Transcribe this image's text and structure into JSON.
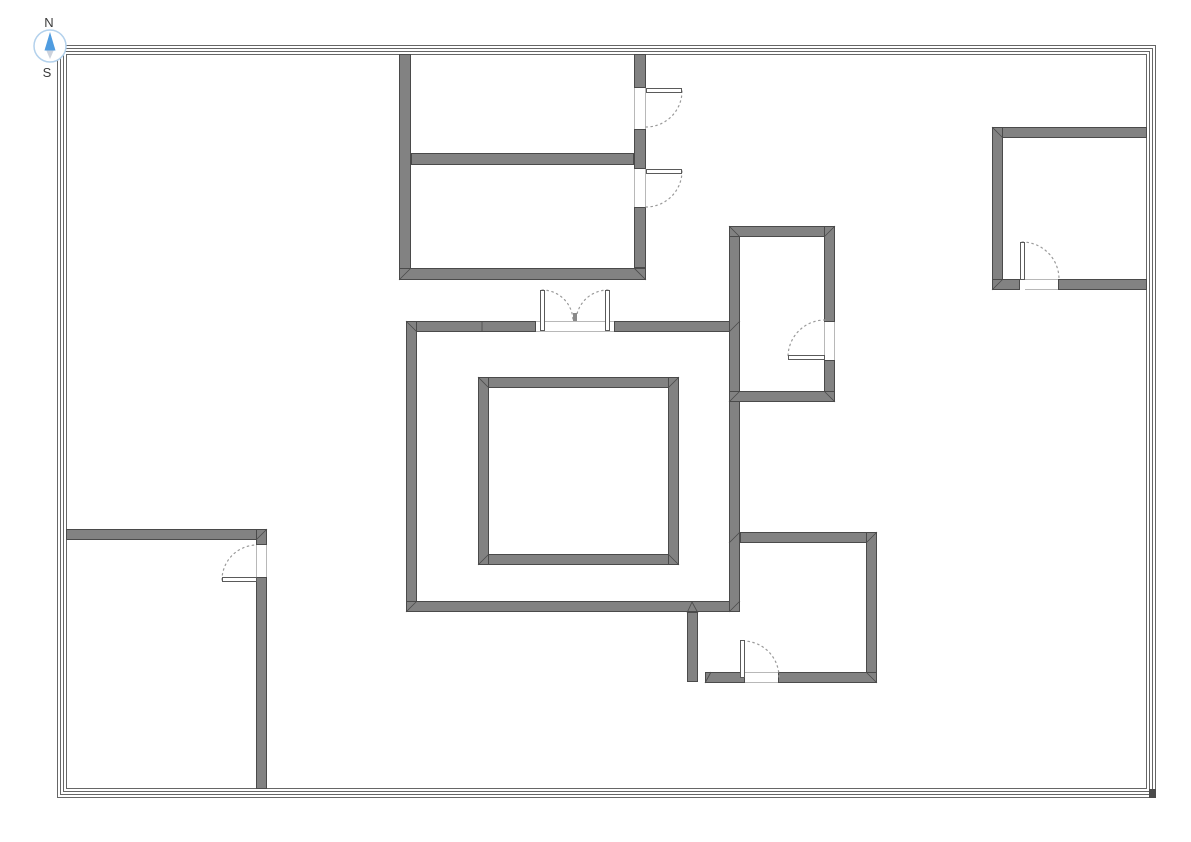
{
  "canvas": {
    "width": 1191,
    "height": 842,
    "background": "#ffffff"
  },
  "colors": {
    "wall_fill": "#828282",
    "wall_stroke": "#4a4a4a",
    "border_line": "#666666",
    "arc_stroke": "#9a9a9a",
    "leaf_fill": "#ffffff",
    "leaf_stroke": "#5a5a5a",
    "threshold_line": "#b8b8b8",
    "seam_stroke": "#4a4a4a",
    "tick_fill": "#8a8a8a",
    "corner_block_fill": "#4a4a4a"
  },
  "compass": {
    "cx": 50,
    "cy": 46,
    "r": 16,
    "ring_color": "#b3d1ec",
    "north_label": "N",
    "south_label": "S",
    "north_color": "#4f9ce0",
    "south_color": "#ccd2dc",
    "label_color": "#3a3a3a",
    "label_font_size": 13,
    "north_points": "50,32 44.5,50.5 55.5,50.5",
    "south_points": "45,47.5 55,47.5 50,59",
    "north_label_x": 49,
    "north_label_y": 27,
    "south_label_x": 47,
    "south_label_y": 77
  },
  "outer_border": {
    "x": 57,
    "y": 45,
    "width": 1099,
    "height": 753,
    "insets": [
      0,
      3,
      6,
      9
    ],
    "corner_block": {
      "x": 1149,
      "y": 789,
      "w": 7,
      "h": 9
    }
  },
  "walls": [
    {
      "name": "top-room-left-wall",
      "x": 399,
      "y": 54,
      "w": 12,
      "h": 226
    },
    {
      "name": "top-room-bottom-wall",
      "x": 399,
      "y": 268,
      "w": 247,
      "h": 12
    },
    {
      "name": "top-room-right-wall-upper",
      "x": 634,
      "y": 54,
      "w": 12,
      "h": 34
    },
    {
      "name": "top-room-right-wall-middle",
      "x": 634,
      "y": 129,
      "w": 12,
      "h": 40
    },
    {
      "name": "top-room-right-wall-lower",
      "x": 634,
      "y": 207,
      "w": 12,
      "h": 61
    },
    {
      "name": "top-room-divider-wall",
      "x": 411,
      "y": 153,
      "w": 223,
      "h": 12
    },
    {
      "name": "central-room-top-wall-left",
      "x": 406,
      "y": 321,
      "w": 130,
      "h": 11
    },
    {
      "name": "central-room-top-wall-right",
      "x": 614,
      "y": 321,
      "w": 126,
      "h": 11
    },
    {
      "name": "central-room-left-wall",
      "x": 406,
      "y": 321,
      "w": 11,
      "h": 291
    },
    {
      "name": "central-room-bottom-wall",
      "x": 406,
      "y": 601,
      "w": 334,
      "h": 11
    },
    {
      "name": "central-room-right-wall",
      "x": 729,
      "y": 226,
      "w": 11,
      "h": 386
    },
    {
      "name": "middle-right-room-top-wall",
      "x": 729,
      "y": 226,
      "w": 106,
      "h": 11
    },
    {
      "name": "middle-right-room-right-wall-upper",
      "x": 824,
      "y": 226,
      "w": 11,
      "h": 96
    },
    {
      "name": "middle-right-room-right-wall-lower",
      "x": 824,
      "y": 360,
      "w": 11,
      "h": 42
    },
    {
      "name": "middle-right-room-bottom-wall",
      "x": 729,
      "y": 391,
      "w": 106,
      "h": 11
    },
    {
      "name": "bottom-right-room-top-wall",
      "x": 740,
      "y": 532,
      "w": 137,
      "h": 11
    },
    {
      "name": "bottom-right-room-right-wall",
      "x": 866,
      "y": 532,
      "w": 11,
      "h": 151
    },
    {
      "name": "bottom-right-room-bottom-wall",
      "x": 778,
      "y": 672,
      "w": 99,
      "h": 11
    },
    {
      "name": "bottom-right-room-bottom-wall-left",
      "x": 705,
      "y": 672,
      "w": 40,
      "h": 11
    },
    {
      "name": "bottom-right-room-left-stub-wall",
      "x": 687,
      "y": 612,
      "w": 11,
      "h": 70
    },
    {
      "name": "bottom-left-room-top-wall",
      "x": 66,
      "y": 529,
      "w": 201,
      "h": 11
    },
    {
      "name": "bottom-left-room-right-wall-upper",
      "x": 256,
      "y": 529,
      "w": 11,
      "h": 16
    },
    {
      "name": "bottom-left-room-right-wall-lower",
      "x": 256,
      "y": 577,
      "w": 11,
      "h": 212
    },
    {
      "name": "top-right-room-top-wall",
      "x": 992,
      "y": 127,
      "w": 155,
      "h": 11
    },
    {
      "name": "top-right-room-left-wall",
      "x": 992,
      "y": 127,
      "w": 11,
      "h": 163
    },
    {
      "name": "top-right-room-bottom-wall-left",
      "x": 992,
      "y": 279,
      "w": 28,
      "h": 11
    },
    {
      "name": "top-right-room-bottom-wall-right",
      "x": 1058,
      "y": 279,
      "w": 89,
      "h": 11
    },
    {
      "name": "inner-square-top-wall",
      "x": 478,
      "y": 377,
      "w": 201,
      "h": 11
    },
    {
      "name": "inner-square-bottom-wall",
      "x": 478,
      "y": 554,
      "w": 201,
      "h": 11
    },
    {
      "name": "inner-square-left-wall",
      "x": 478,
      "y": 377,
      "w": 11,
      "h": 188
    },
    {
      "name": "inner-square-right-wall",
      "x": 668,
      "y": 377,
      "w": 11,
      "h": 188
    }
  ],
  "seams": [
    [
      399,
      280,
      411,
      268
    ],
    [
      646,
      280,
      634,
      268
    ],
    [
      406,
      321,
      417,
      332
    ],
    [
      406,
      612,
      417,
      601
    ],
    [
      740,
      321,
      729,
      332
    ],
    [
      729,
      226,
      740,
      237
    ],
    [
      835,
      226,
      824,
      237
    ],
    [
      835,
      402,
      824,
      391
    ],
    [
      740,
      391,
      729,
      402
    ],
    [
      729,
      612,
      740,
      601
    ],
    [
      740,
      532,
      729,
      543
    ],
    [
      877,
      532,
      866,
      543
    ],
    [
      877,
      683,
      866,
      672
    ],
    [
      267,
      529,
      256,
      540
    ],
    [
      992,
      127,
      1003,
      138
    ],
    [
      992,
      290,
      1003,
      279
    ],
    [
      478,
      377,
      489,
      388
    ],
    [
      679,
      377,
      668,
      388
    ],
    [
      478,
      565,
      489,
      554
    ],
    [
      679,
      565,
      668,
      554
    ],
    [
      482,
      321,
      482,
      332
    ],
    [
      687,
      613,
      692,
      602
    ],
    [
      698,
      613,
      692,
      602
    ],
    [
      705,
      683,
      711,
      672
    ]
  ],
  "doors": [
    {
      "name": "door-top-room-upper",
      "opening": {
        "x": 634,
        "y": 88,
        "w": 12,
        "h": 41,
        "faces": "v"
      },
      "leaves": [
        {
          "x": 646,
          "y": 88,
          "w": 36,
          "h": 5
        }
      ],
      "arcs": [
        "M682 91 A36 36 0 0 1 646 127"
      ]
    },
    {
      "name": "door-top-room-lower",
      "opening": {
        "x": 634,
        "y": 169,
        "w": 12,
        "h": 38,
        "faces": "v"
      },
      "leaves": [
        {
          "x": 646,
          "y": 169,
          "w": 36,
          "h": 5
        }
      ],
      "arcs": [
        "M682 171 A36 36 0 0 1 646 207"
      ]
    },
    {
      "name": "double-door-central-room",
      "opening": {
        "x": 536,
        "y": 321,
        "w": 78,
        "h": 11,
        "faces": "h"
      },
      "leaves": [
        {
          "x": 540,
          "y": 290,
          "w": 5,
          "h": 41
        },
        {
          "x": 605,
          "y": 290,
          "w": 5,
          "h": 41
        }
      ],
      "arcs": [
        "M542 290 A31 31 0 0 1 573 321",
        "M608 290 A32 32 0 0 0 576 321"
      ],
      "tick": {
        "x": 573,
        "y": 313,
        "w": 4,
        "h": 8
      }
    },
    {
      "name": "door-middle-right-room",
      "opening": {
        "x": 824,
        "y": 322,
        "w": 11,
        "h": 38,
        "faces": "v"
      },
      "leaves": [
        {
          "x": 788,
          "y": 355,
          "w": 37,
          "h": 5
        }
      ],
      "arcs": [
        "M825 320 A37 37 0 0 0 788 357"
      ]
    },
    {
      "name": "door-bottom-right-room",
      "opening": {
        "x": 745,
        "y": 672,
        "w": 33,
        "h": 11,
        "faces": "h"
      },
      "leaves": [
        {
          "x": 740,
          "y": 640,
          "w": 5,
          "h": 38
        }
      ],
      "arcs": [
        "M743 641 A36 36 0 0 1 779 677"
      ]
    },
    {
      "name": "door-bottom-left-room",
      "opening": {
        "x": 256,
        "y": 545,
        "w": 11,
        "h": 32,
        "faces": "v"
      },
      "leaves": [
        {
          "x": 222,
          "y": 577,
          "w": 35,
          "h": 5
        }
      ],
      "arcs": [
        "M222 580 A35 35 0 0 1 257 545"
      ]
    },
    {
      "name": "door-top-right-room",
      "opening": {
        "x": 1025,
        "y": 279,
        "w": 33,
        "h": 11,
        "faces": "h"
      },
      "leaves": [
        {
          "x": 1020,
          "y": 242,
          "w": 5,
          "h": 38
        }
      ],
      "arcs": [
        "M1022 242 A37 37 0 0 1 1059 279"
      ]
    }
  ]
}
